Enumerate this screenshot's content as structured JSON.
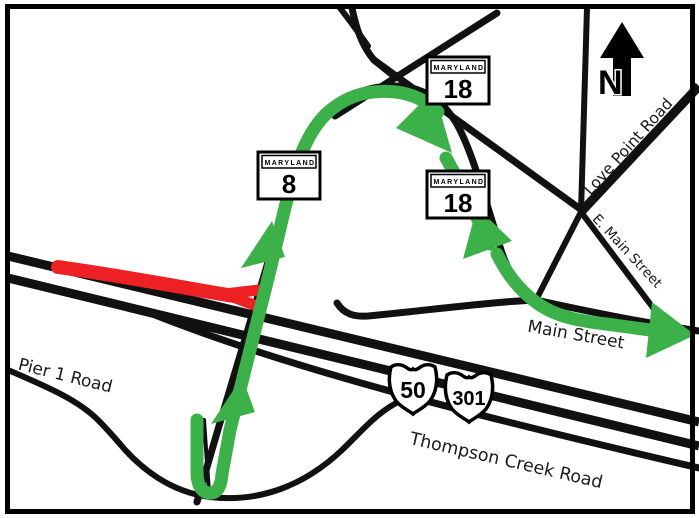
{
  "colors": {
    "detour_green": "#3cb14a",
    "closure_red": "#ed2124",
    "road_black": "#111111",
    "background": "#ffffff",
    "border": "#000000"
  },
  "north_indicator": {
    "label": "N"
  },
  "shields": {
    "md8": {
      "banner": "MARYLAND",
      "number": "8"
    },
    "md18_upper": {
      "banner": "MARYLAND",
      "number": "18"
    },
    "md18_lower": {
      "banner": "MARYLAND",
      "number": "18"
    },
    "us50": {
      "number": "50"
    },
    "us301": {
      "number": "301"
    }
  },
  "road_labels": {
    "love_point_road": "Love Point Road",
    "e_main_street": "E. Main Street",
    "main_street": "Main Street",
    "pier_1_road": "Pier 1 Road",
    "thompson_creek_road": "Thompson Creek Road"
  }
}
